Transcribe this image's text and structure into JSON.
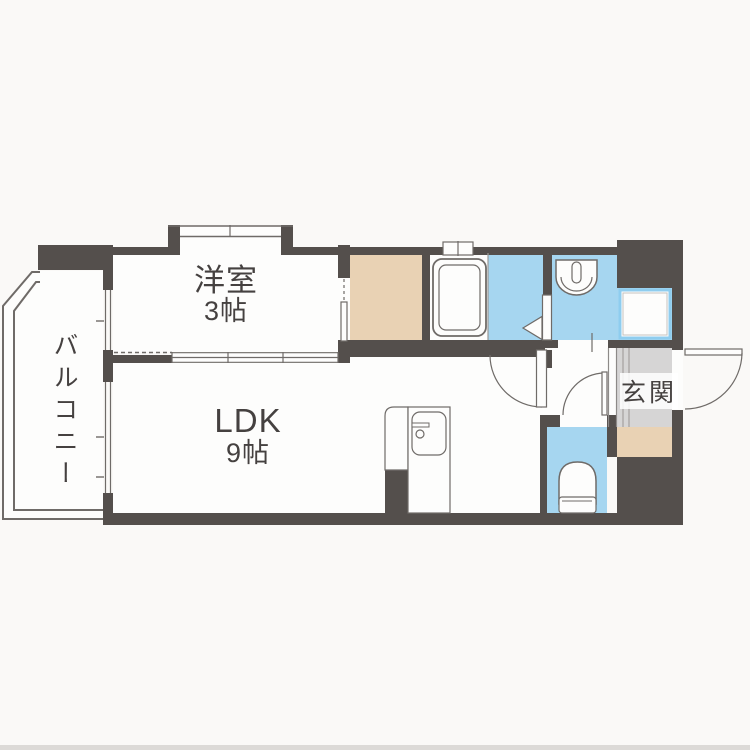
{
  "plan": {
    "type": "apartment-floor-plan",
    "rooms": {
      "western": {
        "label": "洋室",
        "size": "3帖"
      },
      "ldk": {
        "label": "LDK",
        "size": "9帖"
      },
      "balcony": {
        "label": "バルコニー"
      },
      "entrance": {
        "label": "玄関"
      }
    },
    "fixtures": [
      "bathtub",
      "washbasin",
      "washing-machine-pan",
      "toilet",
      "kitchen-counter",
      "kitchen-sink",
      "closet",
      "shoe-storage",
      "bay-window",
      "bath-window",
      "entrance-door",
      "interior-doors",
      "sliding-partition"
    ]
  },
  "colors": {
    "wall": "#544f4c",
    "water": "#a6d6f0",
    "closet": "#e9d2b4",
    "tile": "#d6d5d5",
    "line": "#6f6b68",
    "bg": "#faf9f7",
    "room": "#fdfdfc",
    "text": "#454140"
  }
}
